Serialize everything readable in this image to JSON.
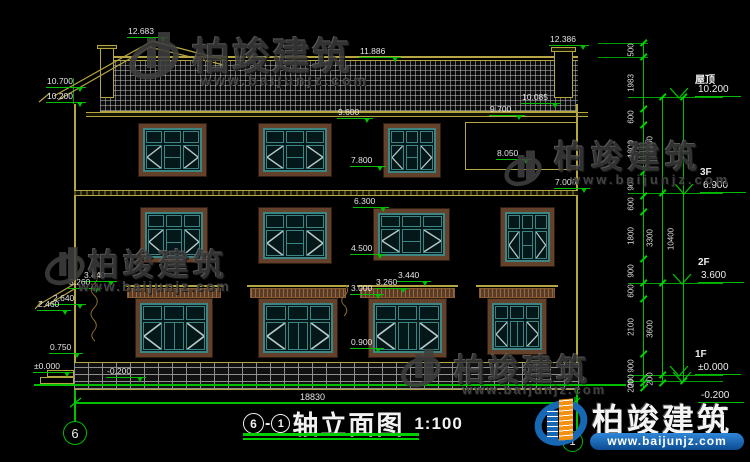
{
  "title_block": {
    "axis_start": "6",
    "separator": "-",
    "axis_end": "1",
    "name": "轴立面图",
    "scale": "1:100"
  },
  "watermark": {
    "cn": "柏竣建筑",
    "url": "www.baijunjz.com"
  },
  "annotations": {
    "overall_width": "18830",
    "axis_bubbles": [
      {
        "label": "6"
      },
      {
        "label": "1"
      }
    ],
    "elevation_markers": [
      {
        "label": "12.683",
        "x": 127,
        "y": 27,
        "w": 42
      },
      {
        "label": "11.886",
        "x": 359,
        "y": 47,
        "w": 42
      },
      {
        "label": "12.386",
        "x": 549,
        "y": 35,
        "w": 40
      },
      {
        "label": "10.700",
        "x": 46,
        "y": 77,
        "w": 40
      },
      {
        "label": "10.200",
        "x": 46,
        "y": 92,
        "w": 40
      },
      {
        "label": "9.600",
        "x": 337,
        "y": 108,
        "w": 36
      },
      {
        "label": "10.085",
        "x": 521,
        "y": 93,
        "w": 40
      },
      {
        "label": "9.700",
        "x": 489,
        "y": 105,
        "w": 36
      },
      {
        "label": "8.050",
        "x": 496,
        "y": 149,
        "w": 36
      },
      {
        "label": "7.800",
        "x": 350,
        "y": 156,
        "w": 36
      },
      {
        "label": "7.000",
        "x": 554,
        "y": 178,
        "w": 36
      },
      {
        "label": "6.300",
        "x": 353,
        "y": 197,
        "w": 36
      },
      {
        "label": "4.500",
        "x": 350,
        "y": 244,
        "w": 36
      },
      {
        "label": "3.440",
        "x": 83,
        "y": 271,
        "w": 34
      },
      {
        "label": "3.260",
        "x": 68,
        "y": 278,
        "w": 34
      },
      {
        "label": "2.640",
        "x": 52,
        "y": 294,
        "w": 34
      },
      {
        "label": "2.460",
        "x": 37,
        "y": 300,
        "w": 34
      },
      {
        "label": "3.440",
        "x": 397,
        "y": 271,
        "w": 34
      },
      {
        "label": "3.260",
        "x": 375,
        "y": 278,
        "w": 34
      },
      {
        "label": "3.000",
        "x": 350,
        "y": 284,
        "w": 34
      },
      {
        "label": "0.900",
        "x": 350,
        "y": 338,
        "w": 34
      },
      {
        "label": "0.750",
        "x": 49,
        "y": 343,
        "w": 34
      },
      {
        "label": "±0.000",
        "x": 33,
        "y": 362,
        "w": 40
      },
      {
        "label": "-0.200",
        "x": 106,
        "y": 367,
        "w": 40
      }
    ],
    "floor_levels": [
      {
        "name": "屋顶",
        "elev": "10.200",
        "x": 695,
        "y": 97
      },
      {
        "name": "3F",
        "elev": "6.900",
        "x": 700,
        "y": 193
      },
      {
        "name": "2F",
        "elev": "3.600",
        "x": 698,
        "y": 283
      },
      {
        "name": "1F",
        "elev": "±0.000",
        "x": 695,
        "y": 375
      },
      {
        "name": "",
        "elev": "-0.200",
        "x": 698,
        "y": 381,
        "below": true
      }
    ],
    "dim_chains": [
      {
        "x": 643,
        "ticks": [
          43,
          57,
          109,
          125,
          172,
          196,
          212,
          259,
          283,
          299,
          354,
          378,
          383,
          388
        ],
        "labels": [
          "500",
          "1983",
          "600",
          "1800",
          "900",
          "600",
          "1800",
          "900",
          "600",
          "2100",
          "900",
          "200",
          "200"
        ]
      },
      {
        "x": 662,
        "ticks": [
          97,
          193,
          283,
          375,
          383
        ],
        "labels": [
          "3300",
          "3300",
          "3600",
          "200"
        ]
      },
      {
        "x": 683,
        "ticks": [
          97,
          381
        ],
        "labels": [
          "10400"
        ]
      }
    ]
  },
  "building": {
    "windows": [
      {
        "x": 138,
        "y": 123,
        "w": 69,
        "h": 54,
        "t": "A"
      },
      {
        "x": 258,
        "y": 123,
        "w": 74,
        "h": 54,
        "t": "A"
      },
      {
        "x": 383,
        "y": 123,
        "w": 58,
        "h": 55,
        "t": "A"
      },
      {
        "x": 140,
        "y": 207,
        "w": 68,
        "h": 56,
        "t": "A"
      },
      {
        "x": 258,
        "y": 207,
        "w": 74,
        "h": 57,
        "t": "A"
      },
      {
        "x": 373,
        "y": 208,
        "w": 77,
        "h": 53,
        "t": "A"
      },
      {
        "x": 500,
        "y": 207,
        "w": 55,
        "h": 60,
        "t": "A"
      },
      {
        "x": 135,
        "y": 298,
        "w": 78,
        "h": 60,
        "t": "B",
        "lintel": true
      },
      {
        "x": 258,
        "y": 298,
        "w": 80,
        "h": 60,
        "t": "B",
        "lintel": true
      },
      {
        "x": 368,
        "y": 298,
        "w": 79,
        "h": 60,
        "t": "B",
        "lintel": true
      },
      {
        "x": 487,
        "y": 298,
        "w": 60,
        "h": 57,
        "t": "B",
        "lintel": true
      }
    ]
  },
  "colors": {
    "background": "#000000",
    "outline_yellow": "#b5a642",
    "dimension_green": "#00bf00",
    "text_white": "#e4e4e4",
    "window_teal": "#3d8585",
    "frame_brown": "#63412a",
    "logo_blue": "#1668b4",
    "logo_orange": "#f29111"
  }
}
